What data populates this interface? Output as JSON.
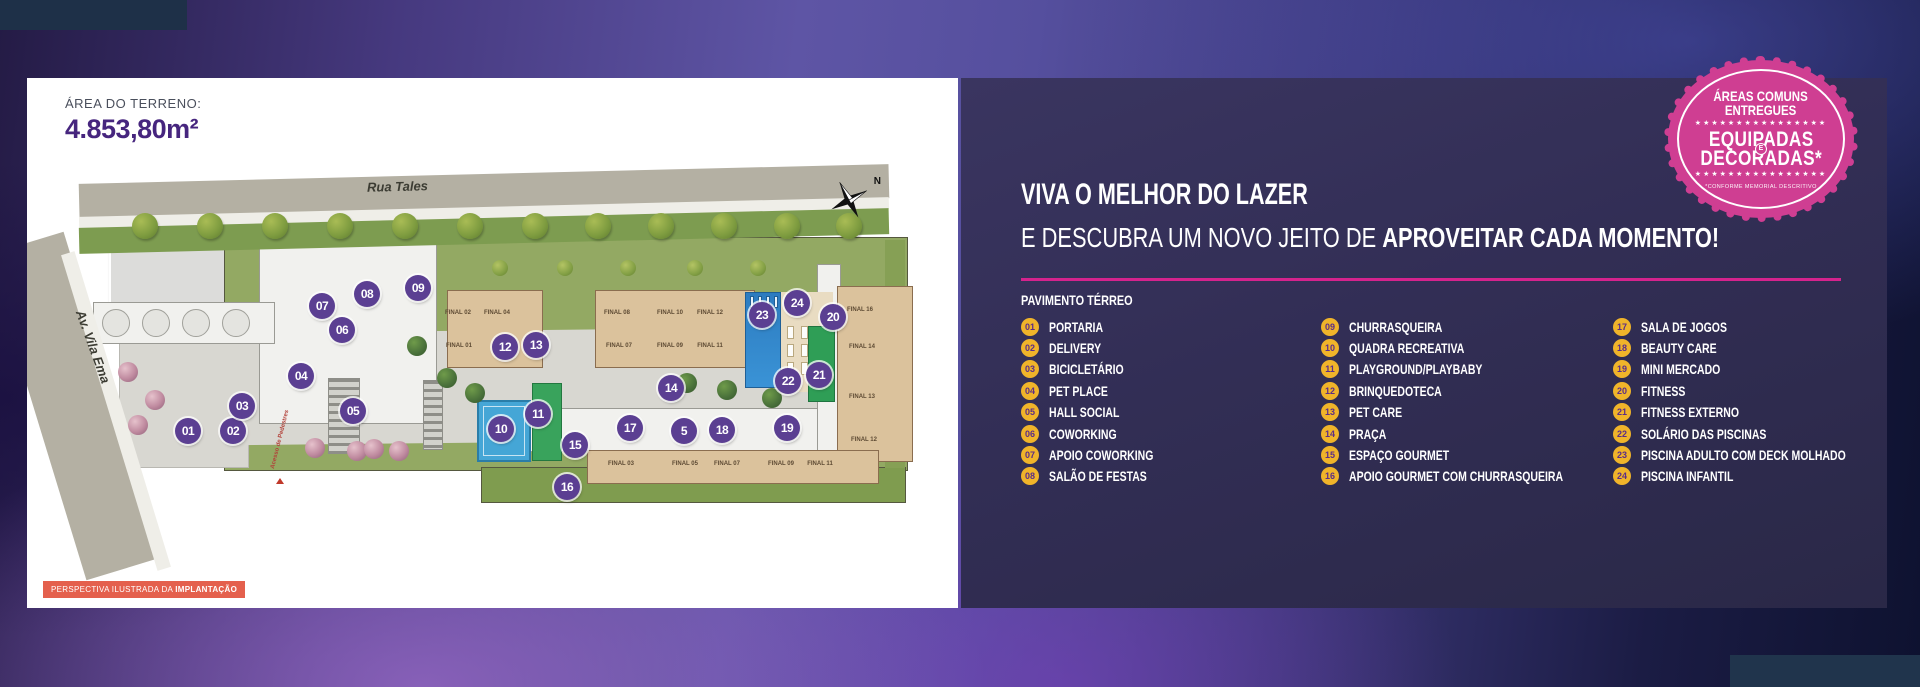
{
  "colors": {
    "accent_pink": "#d5238d",
    "badge_pink": "#cf3e92",
    "legend_yellow": "#f0b42a",
    "marker_purple": "#5b3f92",
    "headline_purple": "#46257e",
    "caption_orange": "#e4604d",
    "panel_navy": "#322e55"
  },
  "left_panel": {
    "area_label": "ÁREA DO TERRENO:",
    "area_value": "4.853,80m²",
    "streets": {
      "top": "Rua Tales",
      "left": "Av. Vila Ema",
      "pedestrian_access": "Acesso de Pedestres"
    },
    "compass_n": "N",
    "caption_prefix": "PERSPECTIVA ILUSTRADA DA ",
    "caption_bold": "IMPLANTAÇÃO",
    "plan": {
      "markers": [
        {
          "n": "01",
          "x": 161,
          "y": 353
        },
        {
          "n": "02",
          "x": 206,
          "y": 353
        },
        {
          "n": "03",
          "x": 215,
          "y": 328
        },
        {
          "n": "04",
          "x": 274,
          "y": 298
        },
        {
          "n": "05",
          "x": 326,
          "y": 333
        },
        {
          "n": "06",
          "x": 315,
          "y": 252
        },
        {
          "n": "07",
          "x": 295,
          "y": 228
        },
        {
          "n": "08",
          "x": 340,
          "y": 216
        },
        {
          "n": "09",
          "x": 391,
          "y": 210
        },
        {
          "n": "10",
          "x": 474,
          "y": 351
        },
        {
          "n": "11",
          "x": 511,
          "y": 336
        },
        {
          "n": "12",
          "x": 478,
          "y": 269
        },
        {
          "n": "13",
          "x": 509,
          "y": 267
        },
        {
          "n": "14",
          "x": 644,
          "y": 310
        },
        {
          "n": "15",
          "x": 548,
          "y": 367
        },
        {
          "n": "16",
          "x": 540,
          "y": 409
        },
        {
          "n": "17",
          "x": 603,
          "y": 350
        },
        {
          "n": "5",
          "x": 657,
          "y": 353
        },
        {
          "n": "18",
          "x": 695,
          "y": 352
        },
        {
          "n": "19",
          "x": 760,
          "y": 350
        },
        {
          "n": "20",
          "x": 806,
          "y": 239
        },
        {
          "n": "21",
          "x": 792,
          "y": 297
        },
        {
          "n": "22",
          "x": 761,
          "y": 303
        },
        {
          "n": "23",
          "x": 735,
          "y": 237
        },
        {
          "n": "24",
          "x": 770,
          "y": 225
        }
      ],
      "building_labels": [
        {
          "t": "FINAL 02",
          "x": 431,
          "y": 235
        },
        {
          "t": "FINAL 04",
          "x": 470,
          "y": 235
        },
        {
          "t": "FINAL 01",
          "x": 432,
          "y": 268
        },
        {
          "t": "FINAL 08",
          "x": 590,
          "y": 235
        },
        {
          "t": "FINAL 10",
          "x": 643,
          "y": 235
        },
        {
          "t": "FINAL 12",
          "x": 683,
          "y": 235
        },
        {
          "t": "FINAL 07",
          "x": 592,
          "y": 268
        },
        {
          "t": "FINAL 09",
          "x": 643,
          "y": 268
        },
        {
          "t": "FINAL 11",
          "x": 683,
          "y": 268
        },
        {
          "t": "FINAL 16",
          "x": 833,
          "y": 232
        },
        {
          "t": "FINAL 14",
          "x": 835,
          "y": 269
        },
        {
          "t": "FINAL 13",
          "x": 835,
          "y": 319
        },
        {
          "t": "FINAL 12",
          "x": 837,
          "y": 362
        },
        {
          "t": "FINAL 03",
          "x": 594,
          "y": 386
        },
        {
          "t": "FINAL 05",
          "x": 658,
          "y": 386
        },
        {
          "t": "FINAL 07",
          "x": 700,
          "y": 386
        },
        {
          "t": "FINAL 09",
          "x": 754,
          "y": 386
        },
        {
          "t": "FINAL 11",
          "x": 793,
          "y": 386
        }
      ],
      "trees_top": {
        "y": 148,
        "xs": [
          118,
          183,
          248,
          313,
          378,
          443,
          508,
          571,
          634,
          697,
          760,
          822
        ]
      },
      "shrubs": {
        "y": 190,
        "xs": [
          473,
          538,
          601,
          668,
          731
        ]
      },
      "inner_trees": [
        {
          "x": 390,
          "y": 268
        },
        {
          "x": 420,
          "y": 300
        },
        {
          "x": 448,
          "y": 315
        },
        {
          "x": 660,
          "y": 305
        },
        {
          "x": 700,
          "y": 312
        },
        {
          "x": 745,
          "y": 320
        }
      ],
      "pink_trees": [
        {
          "x": 288,
          "y": 370
        },
        {
          "x": 330,
          "y": 373
        },
        {
          "x": 347,
          "y": 371
        },
        {
          "x": 372,
          "y": 373
        },
        {
          "x": 101,
          "y": 294
        },
        {
          "x": 111,
          "y": 347
        },
        {
          "x": 128,
          "y": 322
        }
      ]
    }
  },
  "right_panel": {
    "badge": {
      "line1": "ÁREAS COMUNS",
      "line2": "ENTREGUES",
      "stars": "★★★★★★★★★★★★★★★★",
      "big1": "EQUIPADAS",
      "connector": "E",
      "big2": "DECORADAS*",
      "footnote": "*CONFORME MEMORIAL DESCRITIVO"
    },
    "title_line1": "VIVA O MELHOR DO LAZER",
    "title_line2_regular": "E DESCUBRA UM NOVO JEITO DE ",
    "title_line2_bold": "APROVEITAR CADA MOMENTO!",
    "section_label": "PAVIMENTO TÉRREO",
    "legend_columns": [
      [
        {
          "num": "01",
          "label": "PORTARIA"
        },
        {
          "num": "02",
          "label": "DELIVERY"
        },
        {
          "num": "03",
          "label": "BICICLETÁRIO"
        },
        {
          "num": "04",
          "label": "PET PLACE"
        },
        {
          "num": "05",
          "label": "HALL SOCIAL"
        },
        {
          "num": "06",
          "label": "COWORKING"
        },
        {
          "num": "07",
          "label": "APOIO COWORKING"
        },
        {
          "num": "08",
          "label": "SALÃO DE FESTAS"
        }
      ],
      [
        {
          "num": "09",
          "label": "CHURRASQUEIRA"
        },
        {
          "num": "10",
          "label": "QUADRA RECREATIVA"
        },
        {
          "num": "11",
          "label": "PLAYGROUND/PLAYBABY"
        },
        {
          "num": "12",
          "label": "BRINQUEDOTECA"
        },
        {
          "num": "13",
          "label": "PET CARE"
        },
        {
          "num": "14",
          "label": "PRAÇA"
        },
        {
          "num": "15",
          "label": "ESPAÇO GOURMET"
        },
        {
          "num": "16",
          "label": "APOIO GOURMET COM CHURRASQUEIRA"
        }
      ],
      [
        {
          "num": "17",
          "label": "SALA DE JOGOS"
        },
        {
          "num": "18",
          "label": "BEAUTY CARE"
        },
        {
          "num": "19",
          "label": "MINI MERCADO"
        },
        {
          "num": "20",
          "label": "FITNESS"
        },
        {
          "num": "21",
          "label": "FITNESS EXTERNO"
        },
        {
          "num": "22",
          "label": "SOLÁRIO DAS PISCINAS"
        },
        {
          "num": "23",
          "label": "PISCINA ADULTO COM DECK MOLHADO"
        },
        {
          "num": "24",
          "label": "PISCINA INFANTIL"
        }
      ]
    ]
  }
}
